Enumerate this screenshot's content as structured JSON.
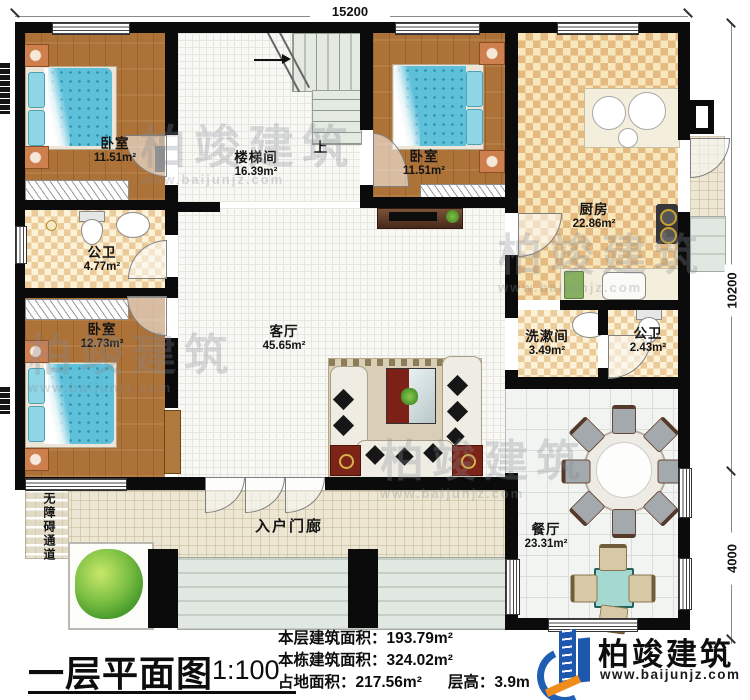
{
  "dimensions": {
    "top": "15200",
    "right_upper": "10200",
    "right_lower": "4000"
  },
  "stair": {
    "up_label": "上"
  },
  "rooms": {
    "bedroom1": {
      "name": "卧室",
      "area": "11.51m²"
    },
    "stairwell": {
      "name": "楼梯间",
      "area": "16.39m²"
    },
    "bedroom2": {
      "name": "卧室",
      "area": "11.51m²"
    },
    "kitchen": {
      "name": "厨房",
      "area": "22.86m²"
    },
    "bathroom1": {
      "name": "公卫",
      "area": "4.77m²"
    },
    "bedroom3": {
      "name": "卧室",
      "area": "12.73m²"
    },
    "living": {
      "name": "客厅",
      "area": "45.65m²"
    },
    "washroom": {
      "name": "洗漱间",
      "area": "3.49m²"
    },
    "bathroom2": {
      "name": "公卫",
      "area": "2.43m²"
    },
    "dining": {
      "name": "餐厅",
      "area": "23.31m²"
    },
    "porch": {
      "name": "入户门廊"
    },
    "ramp": {
      "name": "无障碍通道"
    }
  },
  "title_block": {
    "title": "一层平面图",
    "scale": "1:100",
    "stat1_label": "本层建筑面积：",
    "stat1_value": "193.79m²",
    "stat2_label": "本栋建筑面积：",
    "stat2_value": "324.02m²",
    "stat3_label": "占地面积：",
    "stat3_value": "217.56m²",
    "stat4_label": "层高：",
    "stat4_value": "3.9m"
  },
  "brand": {
    "name": "柏竣建筑",
    "url": "www.baijunjz.com"
  },
  "watermark": {
    "name": "柏竣建筑",
    "url": "www.baijunjz.com"
  }
}
